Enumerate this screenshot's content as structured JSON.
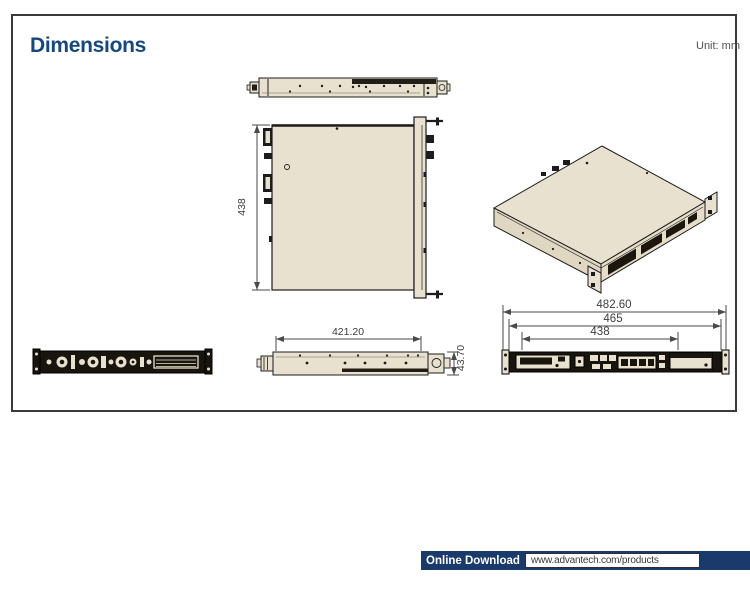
{
  "page": {
    "title": "Dimensions",
    "unit_label": "Unit: mm"
  },
  "views": {
    "top_view": {
      "label": "chassis top view",
      "dim_depth": "438"
    },
    "side_view": {
      "label": "chassis side view",
      "dim_length": "421.20",
      "dim_height": "43.70"
    },
    "rear_view": {
      "label": "chassis rear view",
      "dim_overall_width": "482.60",
      "dim_mid_width": "465",
      "dim_inner_width": "438"
    },
    "front_view": {
      "label": "chassis front view"
    },
    "iso_view": {
      "label": "isometric view"
    }
  },
  "footer": {
    "download_label": "Online Download",
    "url": "www.advantech.com/products"
  },
  "colors": {
    "accent_navy": "#16487f",
    "footer_navy": "#1a3a6b",
    "drawing_fill": "#e9e1cf",
    "drawing_line": "#1c1c1c",
    "dim_line": "#4a4a4a"
  }
}
